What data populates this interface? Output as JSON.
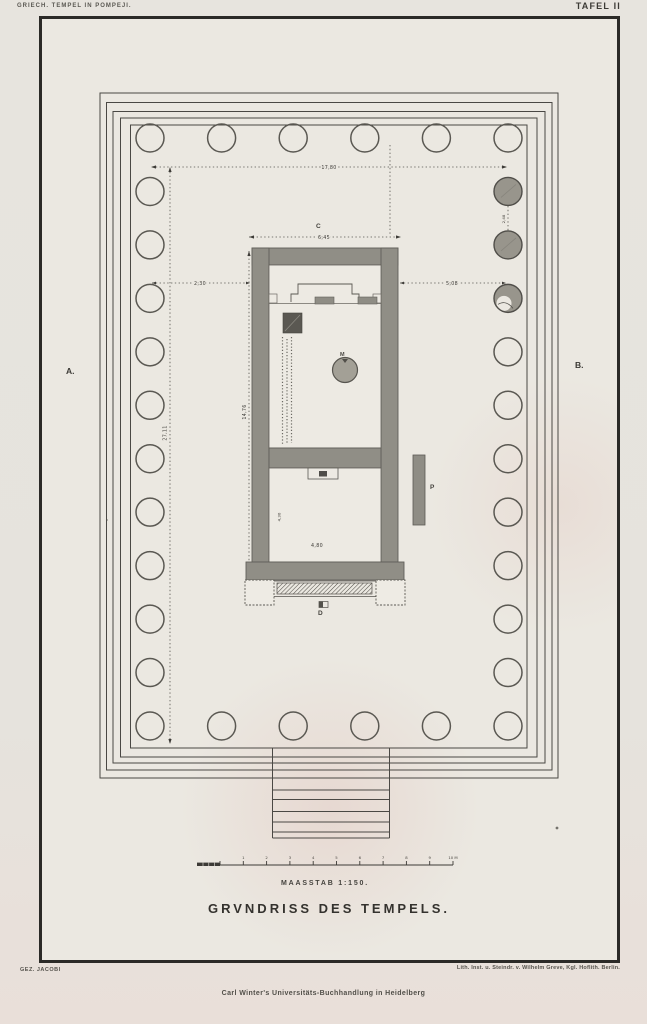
{
  "page": {
    "header_left": "GRIECH. TEMPEL IN POMPEJI.",
    "header_right": "TAFEL II",
    "footer_left": "GEZ. JACOBI",
    "footer_right": "Lith. Inst. u. Steindr. v. Wilhelm Greve, Kgl. Hoflith. Berlin.",
    "imprint": "Carl Winter's Universitäts-Buchhandlung in Heidelberg"
  },
  "plate": {
    "title": "GRVNDRISS DES TEMPELS.",
    "scale_label": "MAASSTAB 1:150.",
    "scale_ticks": [
      "1",
      "2",
      "3",
      "4",
      "5",
      "6",
      "7",
      "8",
      "9",
      "10 M"
    ],
    "section_markers": {
      "left": "A.",
      "right": "B.",
      "top": "C",
      "bottom": "D"
    },
    "feature_labels": {
      "statue_base": "M",
      "pillar": "P"
    },
    "dimensions": {
      "peristyle_width": "17,80",
      "peristyle_length": "27,11",
      "cella_length": "14,76",
      "cella_width": "6,45",
      "west_gap": "2,30",
      "east_gap": "5,08",
      "pronaos_width": "4,80",
      "pronaos_depth": "4,30",
      "column_axis_gap": "2,48"
    },
    "colonnade": {
      "left_x": 150,
      "right_x": 508,
      "top_y": 138,
      "bottom_y": 726,
      "cols": 6,
      "rows": 12,
      "radius": 14,
      "shaded_right_rows": [
        1,
        2
      ],
      "half_shaded_right_rows": [
        3
      ]
    },
    "colors": {
      "paper": "#e6e3dc",
      "plate": "#ebe8e1",
      "ink": "#2b2a27",
      "line": "#4a4844",
      "wall": "#908e86",
      "dark_block": "#5a5852",
      "column_fill": "#98958c"
    }
  }
}
